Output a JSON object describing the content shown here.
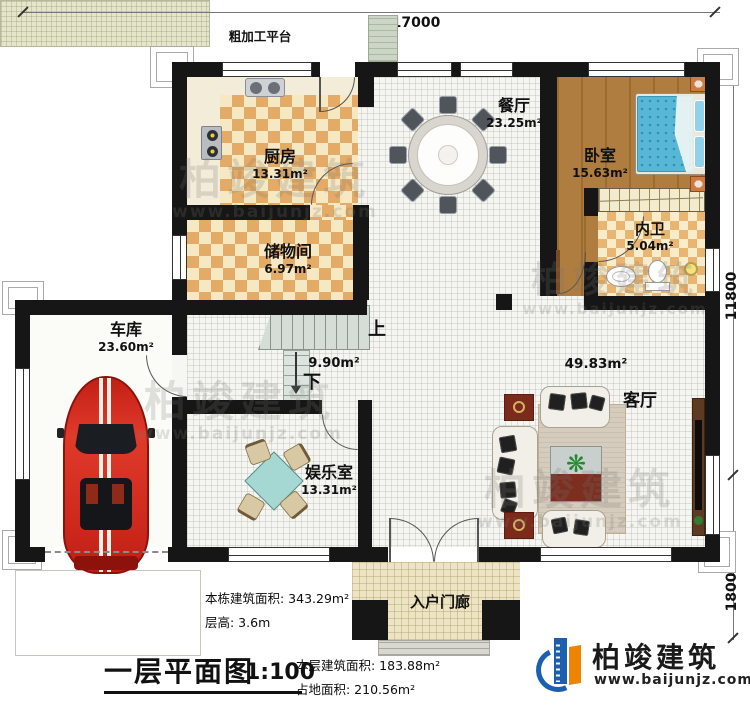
{
  "dimensions": {
    "top": "17000",
    "right_upper": "11800",
    "right_lower": "1800"
  },
  "platform": {
    "label": "粗加工平台"
  },
  "rooms": {
    "kitchen": {
      "name": "厨房",
      "area": "13.31m²"
    },
    "dining": {
      "name": "餐厅",
      "area": "23.25m²"
    },
    "bedroom": {
      "name": "卧室",
      "area": "15.63m²"
    },
    "bath": {
      "name": "内卫",
      "area": "5.04m²"
    },
    "storage": {
      "name": "储物间",
      "area": "6.97m²"
    },
    "garage": {
      "name": "车库",
      "area": "23.60m²"
    },
    "living": {
      "name": "客厅",
      "area": "49.83m²"
    },
    "ent": {
      "name": "娱乐室",
      "area": "13.31m²"
    },
    "porch": {
      "name": "入户门廊"
    },
    "stairhall": {
      "area": "9.90m²"
    }
  },
  "stairs": {
    "up": "上",
    "down": "下"
  },
  "info": {
    "building_area": "本栋建筑面积: 343.29m²",
    "floor_height": "层高: 3.6m",
    "title": "一层平面图",
    "scale": "1:100",
    "floor_area": "本层建筑面积: 183.88m²",
    "footprint": "占地面积: 210.56m²"
  },
  "logo": {
    "name": "柏竣建筑",
    "url": "www.baijunjz.com"
  },
  "watermark": {
    "text": "柏竣建筑",
    "url": "www.baijunjz.com"
  },
  "icons": {
    "plant": "❋"
  },
  "colors": {
    "wall": "#161616",
    "logo_blue": "#1b5fae",
    "logo_orange": "#ee8400",
    "bed_blue": "#58b6d6",
    "car_red": "#d6251d"
  }
}
